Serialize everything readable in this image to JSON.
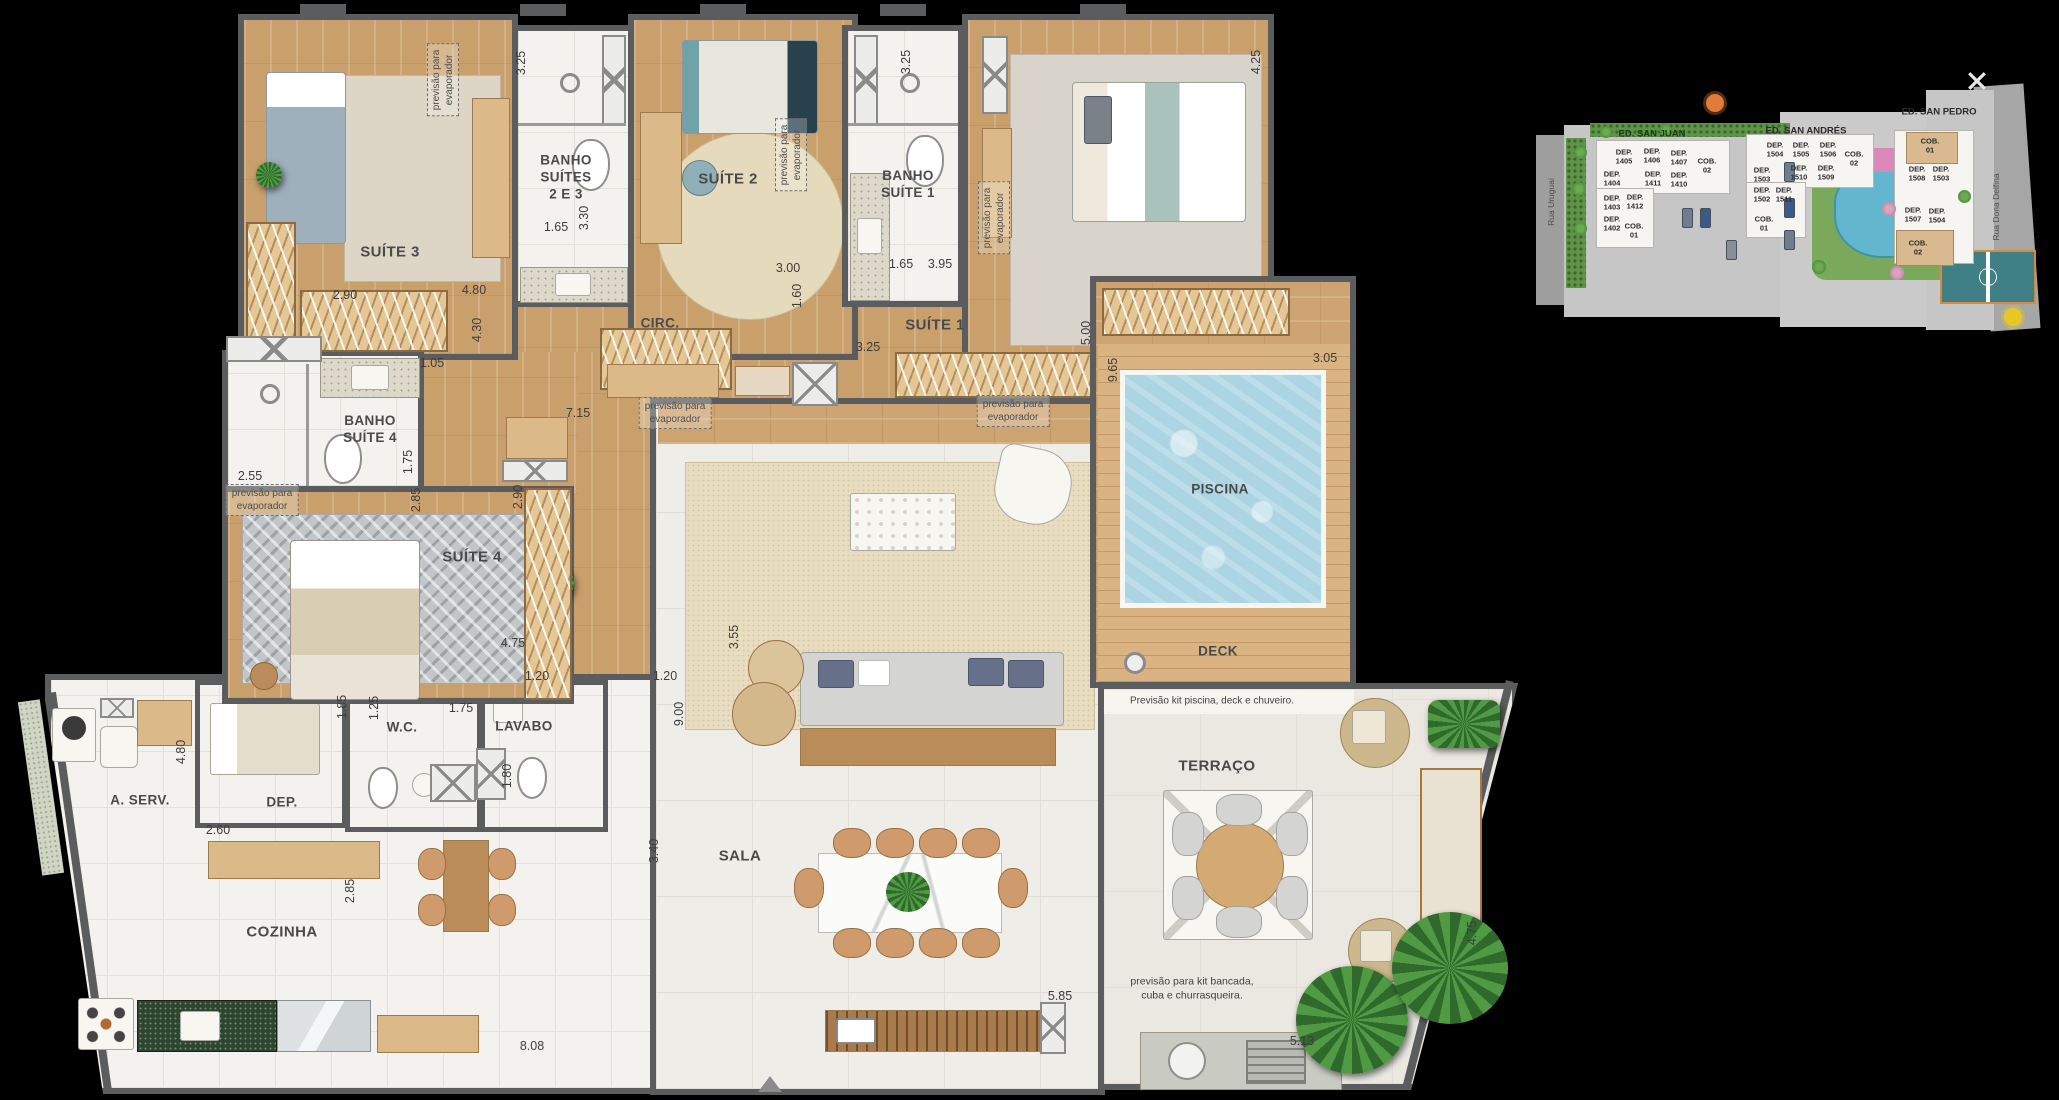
{
  "plan": {
    "rooms": {
      "suite3": "SUÍTE 3",
      "banho23": "BANHO\nSUÍTES\n2 E 3",
      "suite2": "SUÍTE 2",
      "banho1": "BANHO\nSUÍTE 1",
      "suite1": "SUÍTE 1",
      "circ": "CIRC.",
      "banho4": "BANHO\nSUÍTE 4",
      "suite4": "SUÍTE 4",
      "piscina": "PISCINA",
      "deck": "DECK",
      "aserv": "A. SERV.",
      "dep": "DEP.",
      "wc": "W.C.",
      "lavabo": "LAVABO",
      "cozinha": "COZINHA",
      "sala": "SALA",
      "terraco": "TERRAÇO"
    },
    "dims": [
      "3.25",
      "2.90",
      "4.80",
      "1.65",
      "3.30",
      "3.25",
      "3.00",
      "1.60",
      "1.65",
      "3.95",
      "4.25",
      "4.30",
      "1.05",
      "7.15",
      "3.25",
      "5.00",
      "9.65",
      "3.05",
      "2.55",
      "1.75",
      "2.85",
      "2.90",
      "4.75",
      "3.55",
      "1.20",
      "1.20",
      "9.00",
      "1.85",
      "1.25",
      "1.75",
      "1.80",
      "4.80",
      "2.60",
      "2.85",
      "3.40",
      "8.08",
      "5.85",
      "5.13",
      "4.75"
    ],
    "notes": {
      "evaporator": "previsão para\nevaporador",
      "pool_kit": "Previsão kit piscina, deck e chuveiro.",
      "counter_kit": "previsão para kit bancada,\ncuba e churrasqueira."
    }
  },
  "site_plan": {
    "buildings": [
      "ED. SAN JUAN",
      "ED. SAN ANDRÉS",
      "ED. SAN PEDRO"
    ],
    "streets": [
      "Rua Uruguai",
      "Rua Dona Delfina"
    ],
    "units": [
      "DEP.\n1405",
      "DEP.\n1406",
      "DEP.\n1407",
      "COB.\n02",
      "DEP.\n1404",
      "DEP.\n1411",
      "DEP.\n1410",
      "DEP.\n1403",
      "DEP.\n1412",
      "DEP.\n1402",
      "COB.\n01",
      "DEP.\n1504",
      "DEP.\n1505",
      "DEP.\n1506",
      "COB.\n02",
      "DEP.\n1503",
      "DEP.\n1510",
      "DEP.\n1509",
      "DEP.\n1502",
      "DEP.\n1511",
      "COB.\n01",
      "COB.\n01",
      "DEP.\n1508",
      "DEP.\n1503",
      "DEP.\n1507",
      "DEP.\n1504",
      "COB.\n02"
    ]
  },
  "colors": {
    "wall": "#5b5c5d",
    "wood_floor": "#c9a06c",
    "tile_floor": "#f3f2ee",
    "pool_water": "#abd5e3",
    "deck_wood": "#d9b382",
    "site_green": "#5f9348"
  }
}
